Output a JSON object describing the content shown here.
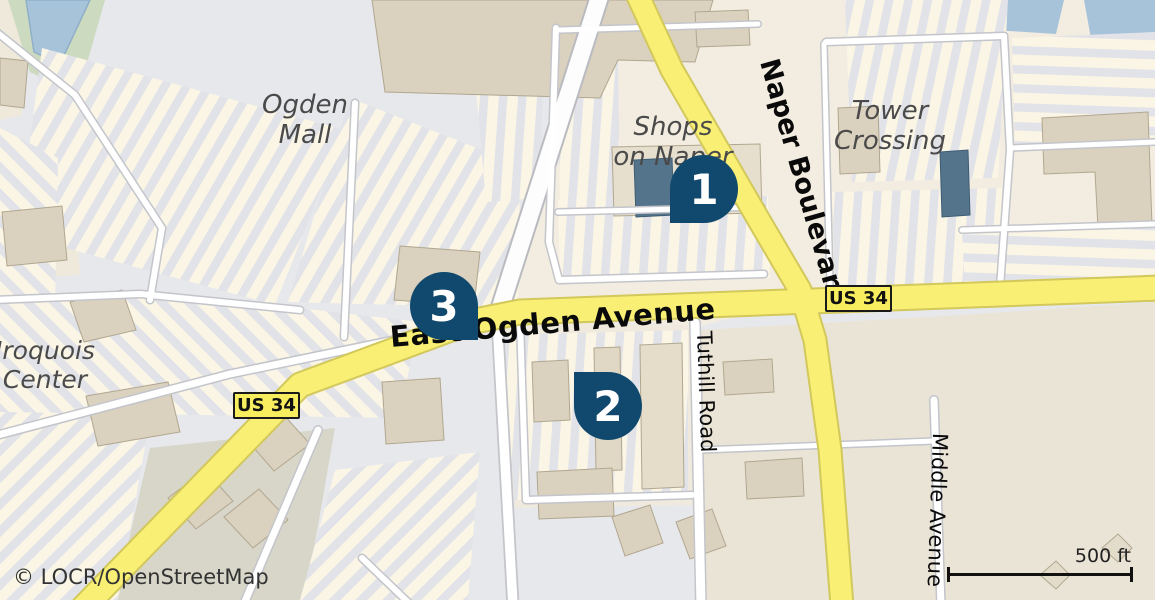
{
  "map": {
    "attribution": "© LOCR/OpenStreetMap",
    "scale_bar": {
      "label": "500 ft"
    },
    "route_shields": [
      {
        "label": "US 34"
      },
      {
        "label": "US 34"
      }
    ],
    "street_labels": {
      "ogden": "East Ogden Avenue",
      "naper": "Naper Boulevard",
      "tuthill": "Tuthill Road",
      "middle": "Middle Avenue"
    },
    "place_labels": [
      {
        "line1": "Ogden",
        "line2": "Mall"
      },
      {
        "line1": "Shops",
        "line2": "on Naper"
      },
      {
        "line1": "Tower",
        "line2": "Crossing"
      },
      {
        "line1": "Iroquois",
        "line2": "Center"
      }
    ],
    "markers": [
      {
        "number": "1"
      },
      {
        "number": "2"
      },
      {
        "number": "3"
      }
    ],
    "colors": {
      "marker": "#10496d",
      "road_primary": "#f8ef74",
      "water": "#a7c3da",
      "greenspace": "#ccdabf",
      "building": "#dbd1bf",
      "shield_bg": "#f7ed5e"
    }
  }
}
